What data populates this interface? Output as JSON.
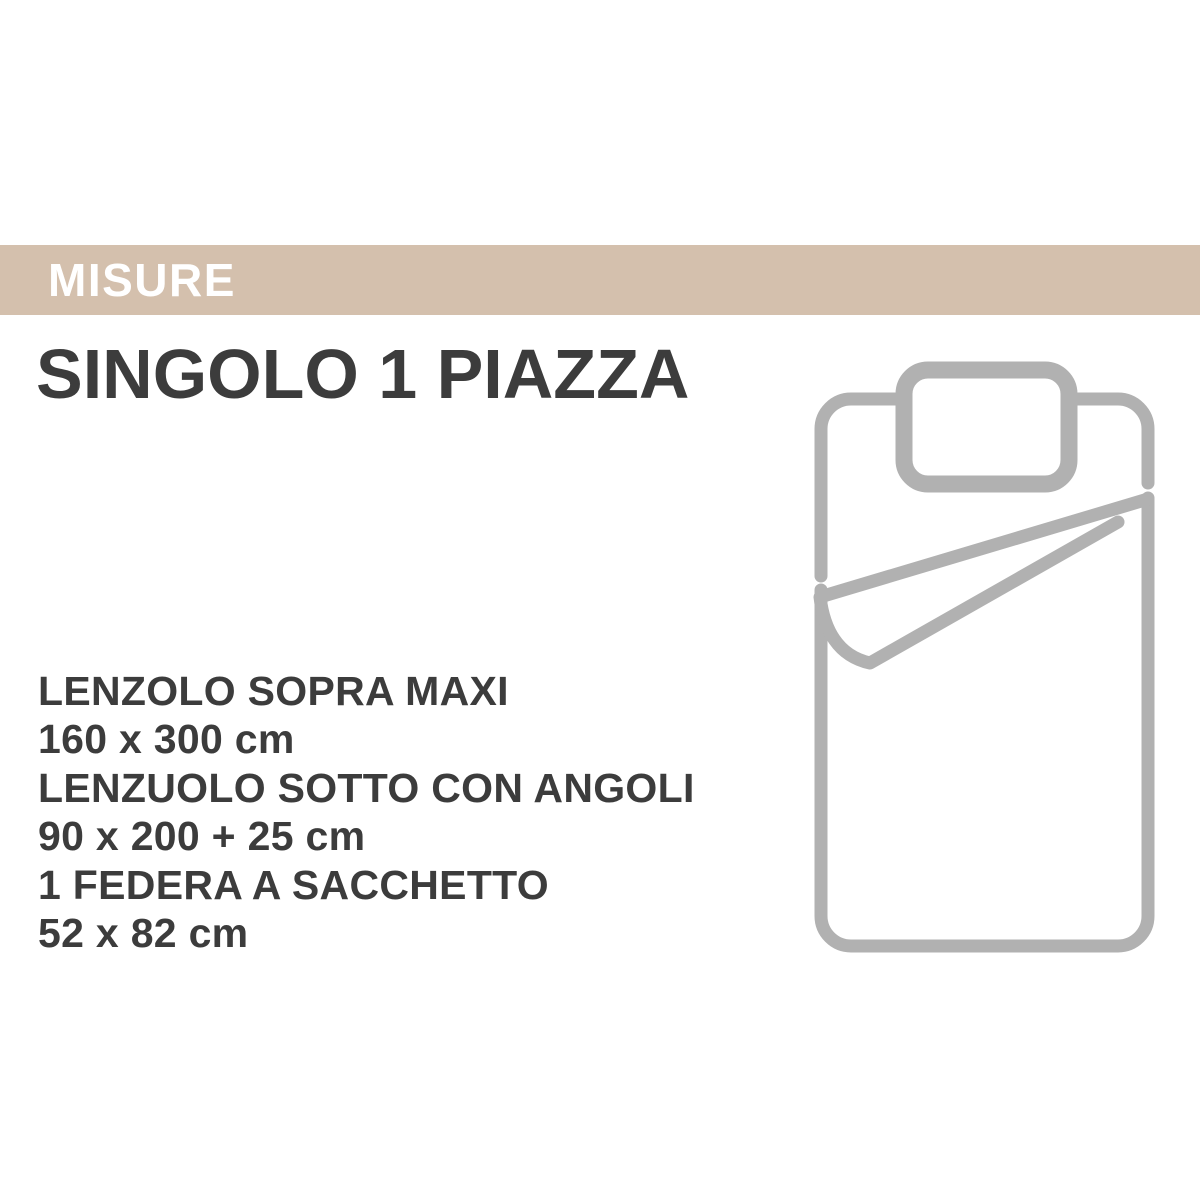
{
  "header": {
    "label": "MISURE"
  },
  "title": "SINGOLO 1 PIAZZA",
  "specs": [
    {
      "label": "LENZOLO SOPRA MAXI",
      "size": "160 x 300 cm"
    },
    {
      "label": "LENZUOLO SOTTO CON ANGOLI",
      "size": "90 x 200 + 25 cm"
    },
    {
      "label": "1 FEDERA A SACCHETTO",
      "size": "52 x 82 cm"
    }
  ],
  "illustration": {
    "icon": "single-bed-with-pillow-and-folded-sheet-icon"
  },
  "colors": {
    "page_background": "#ffffff",
    "header_background": "#d4c0ad",
    "header_text": "#ffffff",
    "body_text": "#3c3c3c",
    "illustration_stroke": "#b1b1b1"
  }
}
